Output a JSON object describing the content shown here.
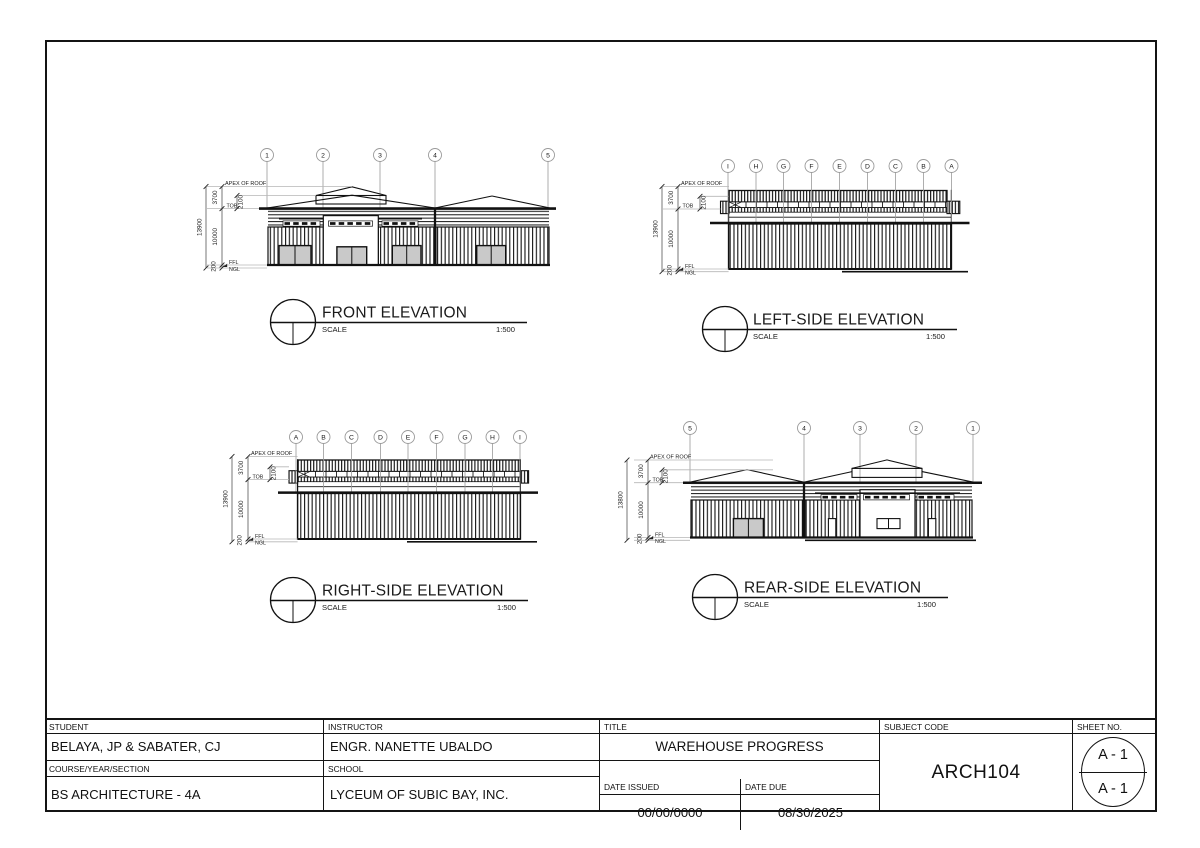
{
  "elevations": {
    "front": {
      "title": "FRONT ELEVATION",
      "scale_label": "SCALE",
      "scale_value": "1:500",
      "grid_labels": [
        "1",
        "2",
        "3",
        "4",
        "5"
      ],
      "dims": {
        "total": "13900",
        "roof": "3700",
        "monitor": "2100",
        "wall": "10000",
        "plinth": "200"
      },
      "levels": {
        "apex": "APEX OF ROOF",
        "tob": "TOB",
        "ffl": "FFL",
        "ngl": "NGL"
      }
    },
    "left": {
      "title": "LEFT-SIDE ELEVATION",
      "scale_label": "SCALE",
      "scale_value": "1:500",
      "grid_labels": [
        "I",
        "H",
        "G",
        "F",
        "E",
        "D",
        "C",
        "B",
        "A"
      ],
      "dims": {
        "total": "13900",
        "roof": "3700",
        "monitor": "2100",
        "wall": "10000",
        "plinth": "200"
      },
      "levels": {
        "apex": "APEX OF ROOF",
        "tob": "TOB",
        "ffl": "FFL",
        "ngl": "NGL"
      }
    },
    "right": {
      "title": "RIGHT-SIDE ELEVATION",
      "scale_label": "SCALE",
      "scale_value": "1:500",
      "grid_labels": [
        "A",
        "B",
        "C",
        "D",
        "E",
        "F",
        "G",
        "H",
        "I"
      ],
      "dims": {
        "total": "13900",
        "roof": "3700",
        "monitor": "2100",
        "wall": "10000",
        "plinth": "200"
      },
      "levels": {
        "apex": "APEX OF ROOF",
        "tob": "TOB",
        "ffl": "FFL",
        "ngl": "NGL"
      }
    },
    "rear": {
      "title": "REAR-SIDE ELEVATION",
      "scale_label": "SCALE",
      "scale_value": "1:500",
      "grid_labels": [
        "5",
        "4",
        "3",
        "2",
        "1"
      ],
      "dims": {
        "total": "13800",
        "roof": "3700",
        "monitor": "2100",
        "wall": "10000",
        "plinth": "200"
      },
      "levels": {
        "apex": "APEX OF ROOF",
        "tob": "TOB",
        "ffl": "FFL",
        "ngl": "NGL"
      }
    }
  },
  "title_block": {
    "student_label": "STUDENT",
    "student": "BELAYA, JP & SABATER, CJ",
    "instructor_label": "INSTRUCTOR",
    "instructor": "ENGR. NANETTE UBALDO",
    "course_label": "COURSE/YEAR/SECTION",
    "course": "BS ARCHITECTURE - 4A",
    "school_label": "SCHOOL",
    "school": "LYCEUM OF SUBIC BAY, INC.",
    "title_label": "TITLE",
    "title": "WAREHOUSE PROGRESS",
    "date_issued_label": "DATE ISSUED",
    "date_issued": "00/00/0000",
    "date_due_label": "DATE DUE",
    "date_due": "08/30/2025",
    "subject_code_label": "SUBJECT CODE",
    "subject_code": "ARCH104",
    "sheet_no_label": "SHEET NO.",
    "sheet_no_top": "A - 1",
    "sheet_no_bottom": "A - 1"
  }
}
